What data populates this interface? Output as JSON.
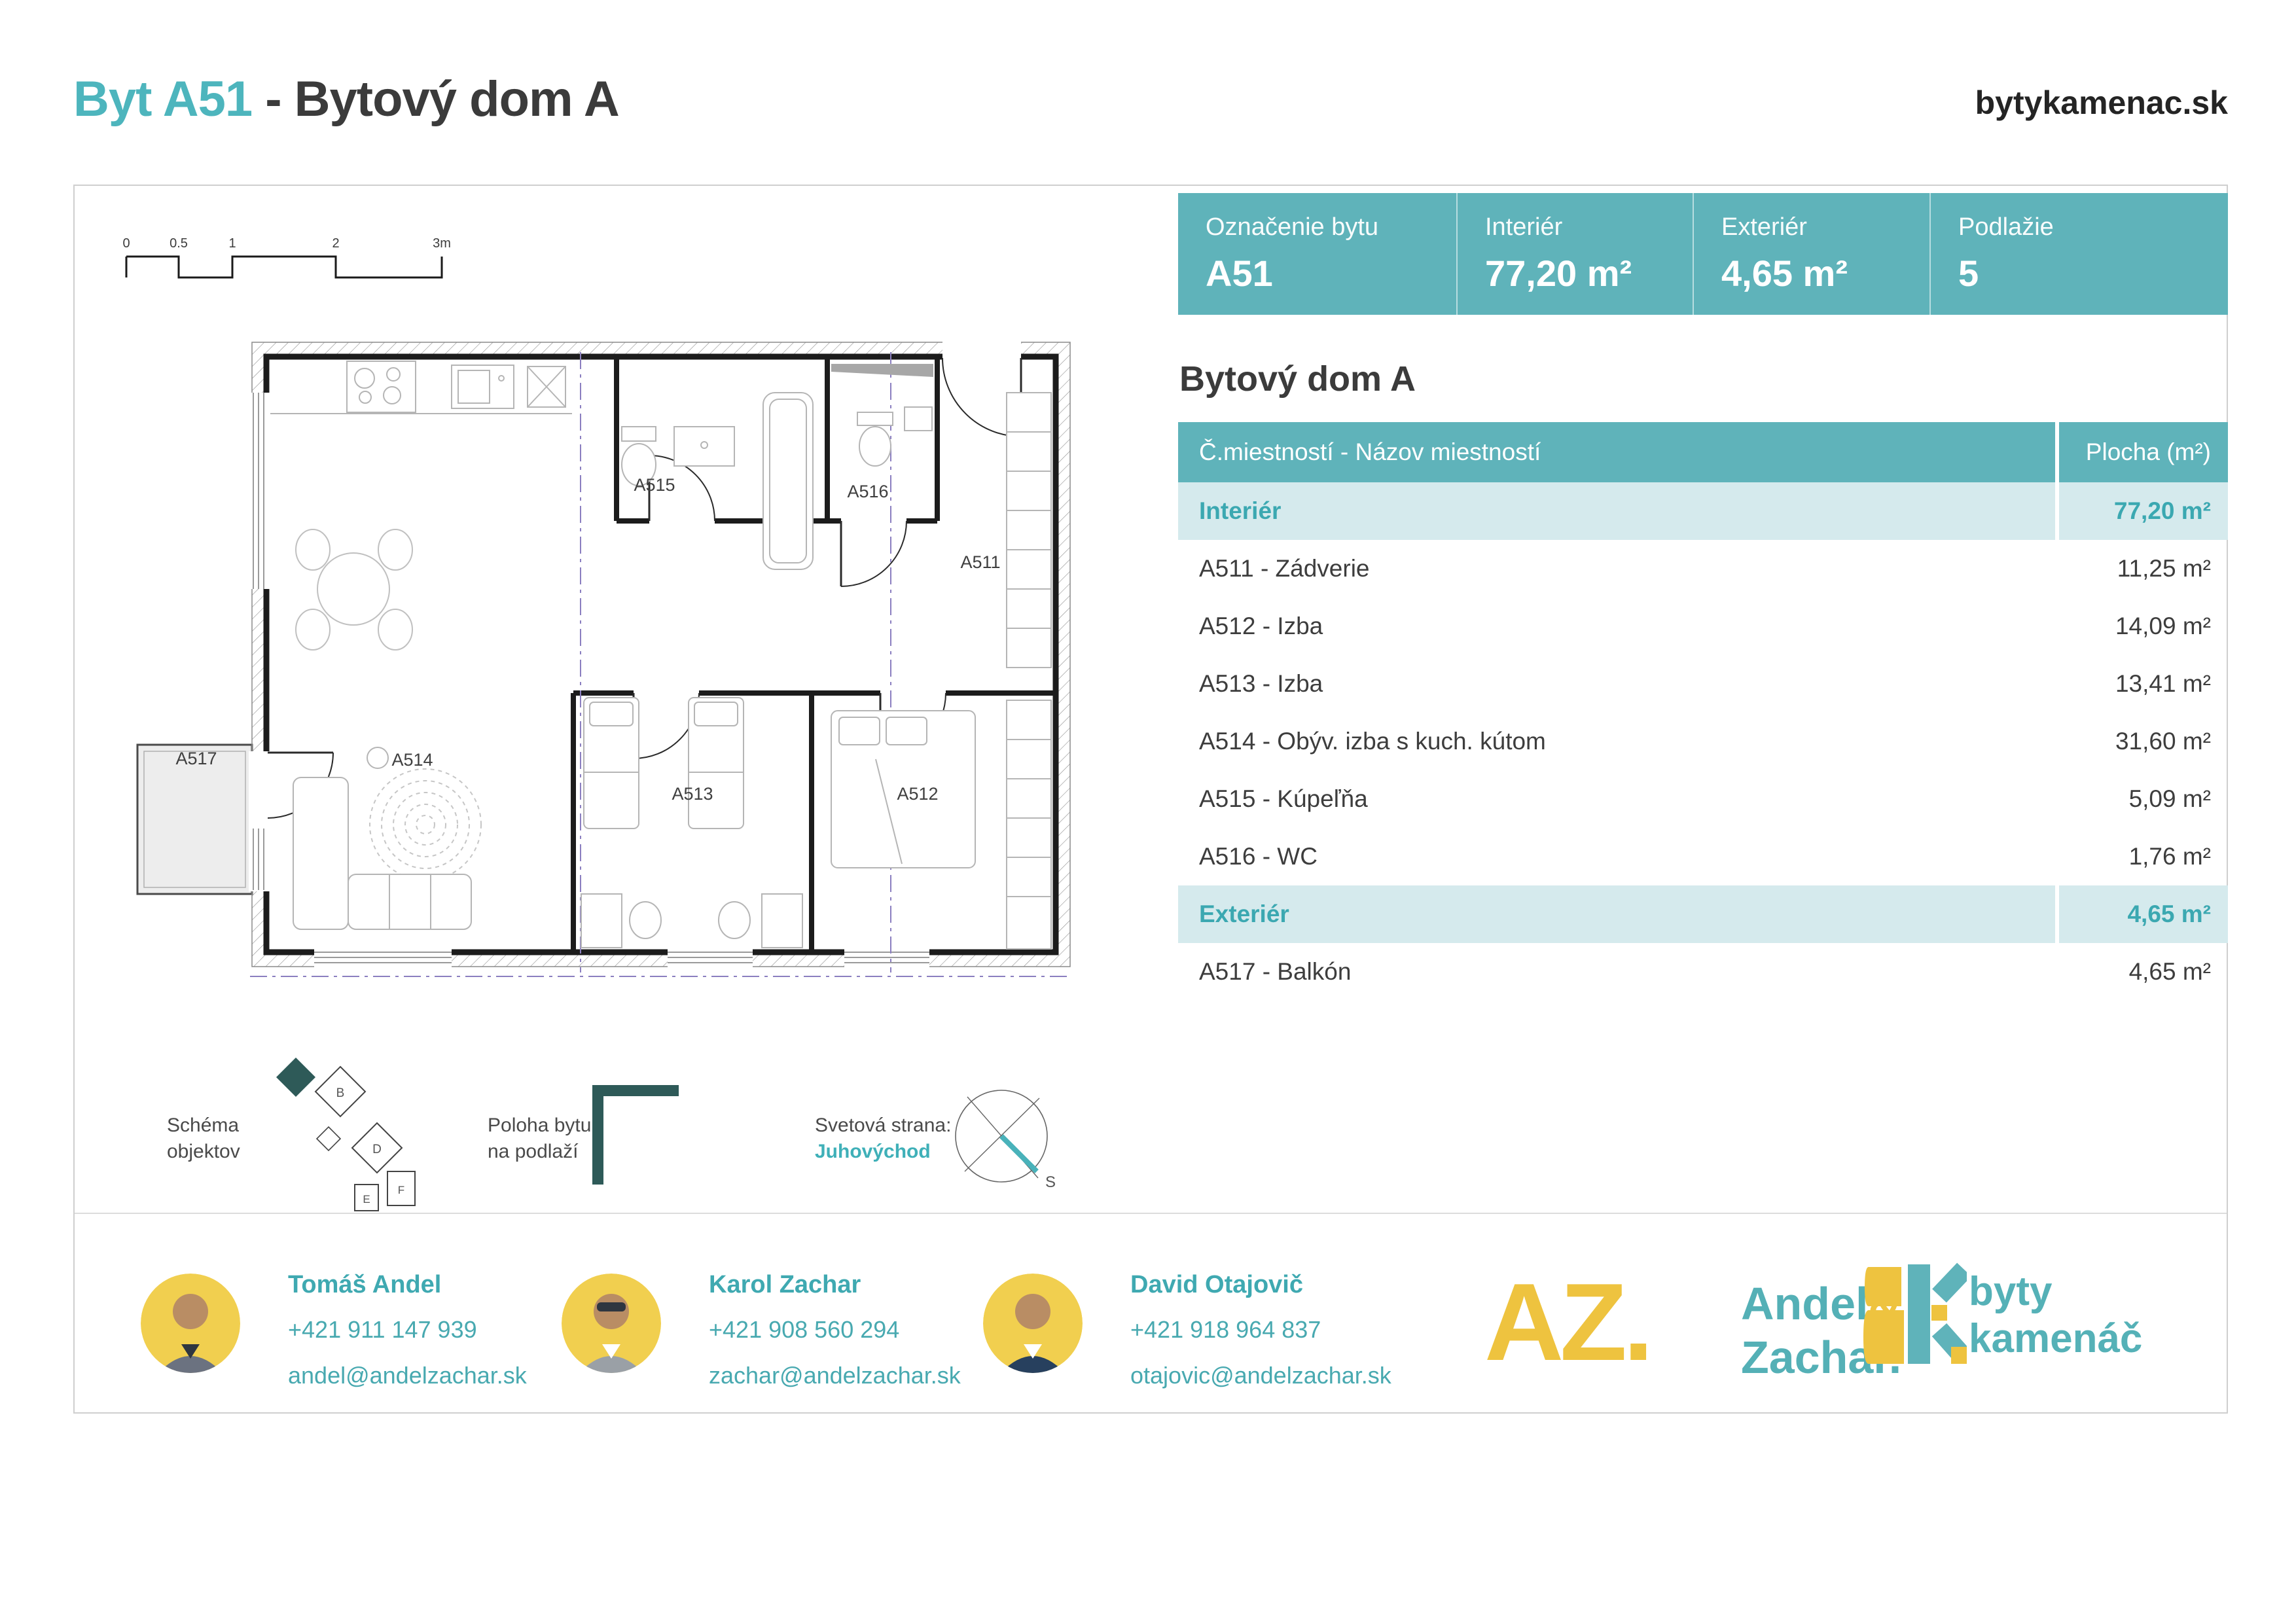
{
  "header": {
    "title_highlight": "Byt A51",
    "title_rest": "- Bytový dom A",
    "website": "bytykamenac.sk"
  },
  "info_bar": {
    "cells": [
      {
        "label": "Označenie bytu",
        "value": "A51"
      },
      {
        "label": "Interiér",
        "value": "77,20 m²"
      },
      {
        "label": "Exteriér",
        "value": "4,65 m²"
      },
      {
        "label": "Podlažie",
        "value": "5"
      }
    ]
  },
  "rooms_table": {
    "title": "Bytový dom A",
    "columns": {
      "room": "Č.miestností - Názov miestností",
      "area": "Plocha (m²)"
    },
    "rows": [
      {
        "name": "Interiér",
        "area": "77,20 m²"
      },
      {
        "name": "A511 - Zádverie",
        "area": "11,25 m²"
      },
      {
        "name": "A512 - Izba",
        "area": "14,09 m²"
      },
      {
        "name": "A513 - Izba",
        "area": "13,41 m²"
      },
      {
        "name": "A514 - Obýv. izba s kuch. kútom",
        "area": "31,60 m²"
      },
      {
        "name": "A515 - Kúpeľňa",
        "area": "5,09 m²"
      },
      {
        "name": "A516 - WC",
        "area": "1,76 m²"
      },
      {
        "name": "Exteriér",
        "area": "4,65 m²"
      },
      {
        "name": "A517 - Balkón",
        "area": "4,65 m²"
      }
    ]
  },
  "floor_plan": {
    "room_labels": {
      "a511": "A511",
      "a512": "A512",
      "a513": "A513",
      "a514": "A514",
      "a515": "A515",
      "a516": "A516",
      "a517": "A517"
    },
    "scale": {
      "t0": "0",
      "t05": "0.5",
      "t1": "1",
      "t2": "2",
      "t3": "3m"
    }
  },
  "legend": {
    "schema_label_line1": "Schéma",
    "schema_label_line2": "objektov",
    "buildings": {
      "b": "B",
      "d": "D",
      "e": "E",
      "f": "F"
    },
    "position_label_line1": "Poloha bytu",
    "position_label_line2": "na podlaží",
    "compass_label": "Svetová strana:",
    "compass_value": "Juhovýchod",
    "compass_letter": "S"
  },
  "contacts": [
    {
      "name": "Tomáš Andel",
      "phone": "+421 911 147 939",
      "email": "andel@andelzachar.sk"
    },
    {
      "name": "Karol Zachar",
      "phone": "+421 908 560 294",
      "email": "zachar@andelzachar.sk"
    },
    {
      "name": "David Otajovič",
      "phone": "+421 918 964 837",
      "email": "otajovic@andelzachar.sk"
    }
  ],
  "logos": {
    "az_mark": "AZ.",
    "az_name_1": "Andel",
    "az_amp": "&",
    "az_name_2": "Zachar.",
    "bk_name_1": "byty",
    "bk_name_2": "kamenáč"
  },
  "colors": {
    "teal": "#5fb3ba",
    "teal_text": "#3fa9b1",
    "teal_row": "#d5eaed",
    "yellow": "#eec33f",
    "dark_slate": "#2e5a58",
    "text_dark": "#3b3b3b"
  }
}
